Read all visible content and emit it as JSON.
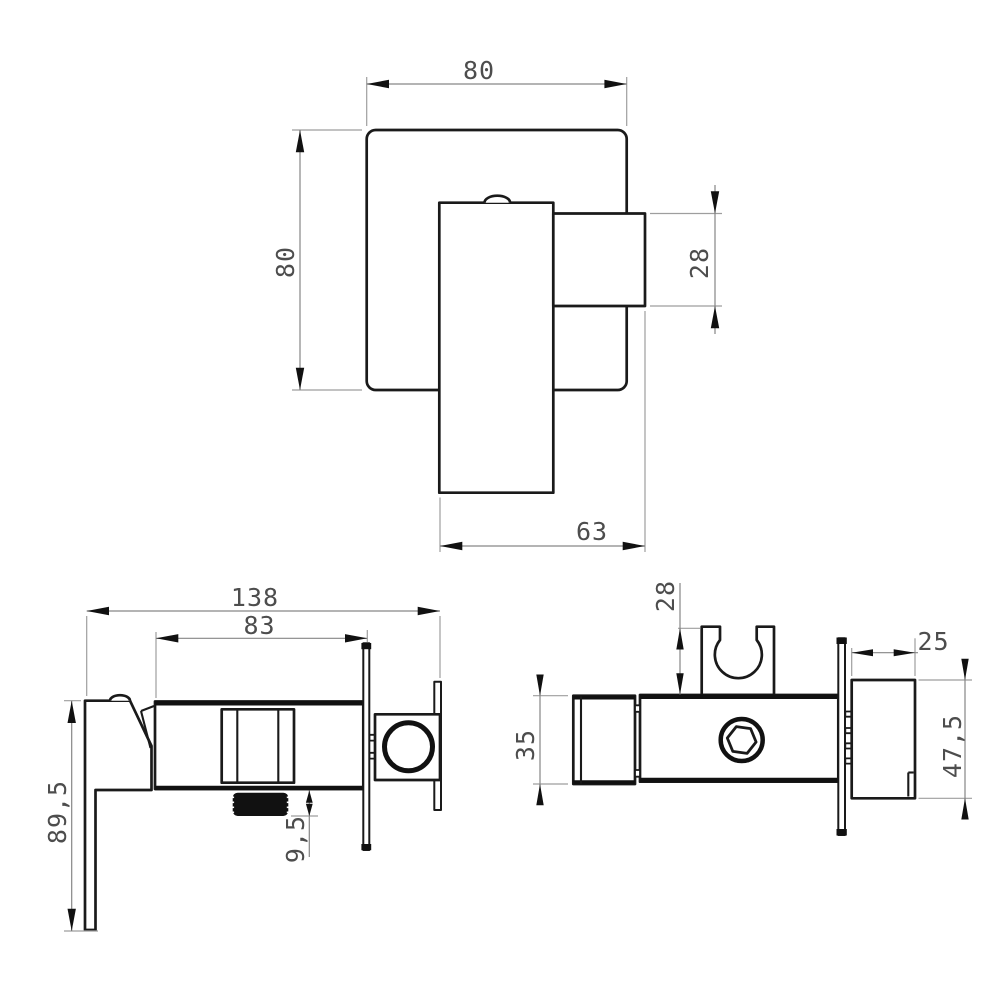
{
  "title": "Concealed shower mixer dimensional drawing",
  "palette": {
    "background": "#ffffff",
    "outline": "#1a1a1a",
    "dim_line": "#868686",
    "ext_line": "#9e9e9e",
    "arrow": "#111111",
    "text": "#4d4d4d"
  },
  "views": {
    "front": {
      "label": "front-view",
      "dims": {
        "plate_width": "80",
        "plate_height": "80",
        "lever_hub_height": "28",
        "handle_length": "63"
      }
    },
    "side": {
      "label": "side-view",
      "dims": {
        "total_depth": "138",
        "body_depth": "83",
        "total_height": "89,5",
        "outlet_thread_length": "9,5"
      }
    },
    "holder": {
      "label": "holder-view",
      "dims": {
        "clip_height": "28",
        "body_height": "35",
        "bracket_depth": "25",
        "bracket_height": "47,5"
      }
    }
  }
}
